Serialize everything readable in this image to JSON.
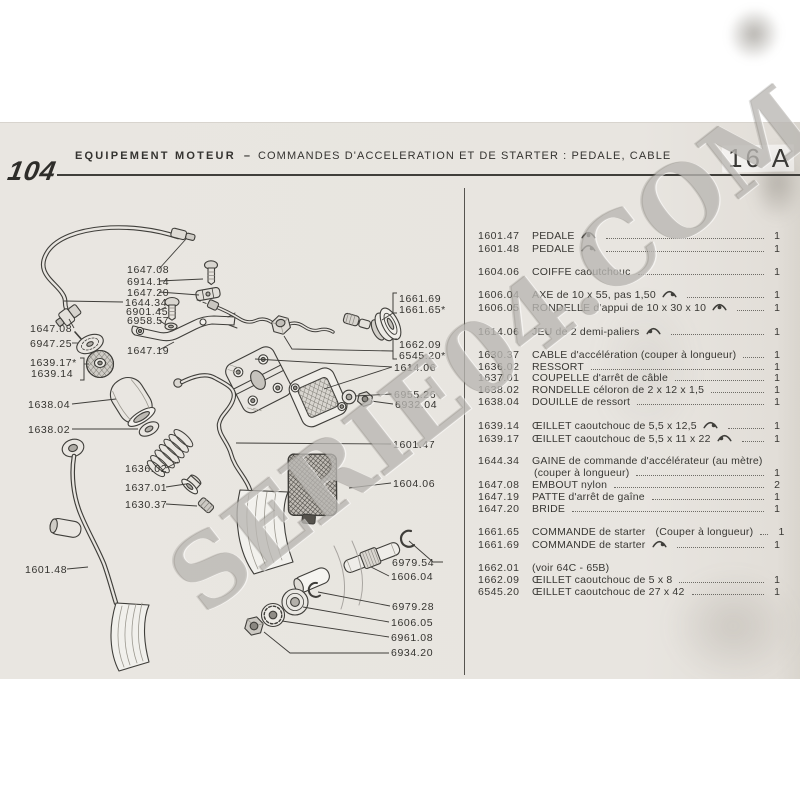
{
  "page": {
    "model": "104",
    "section_title": "EQUIPEMENT MOTEUR",
    "separator": "–",
    "subtitle": "COMMANDES D'ACCELERATION ET DE STARTER : PEDALE, CABLE",
    "page_number": "16 A"
  },
  "watermark": {
    "text": "SERIE04.COM"
  },
  "parts_list": {
    "groups": [
      [
        {
          "ref": "1601.47",
          "desc": "PEDALE",
          "icon": "c",
          "qty": "1"
        },
        {
          "ref": "1601.48",
          "desc": "PEDALE",
          "icon": "r",
          "qty": "1"
        }
      ],
      [
        {
          "ref": "1604.06",
          "desc": "COIFFE caoutchouc",
          "qty": "1"
        }
      ],
      [
        {
          "ref": "1606.04",
          "desc": "AXE de 10 x 55, pas 1,50",
          "icon": "r",
          "qty": "1"
        },
        {
          "ref": "1606.05",
          "desc": "RONDELLE d'appui de 10 x 30 x 10",
          "icon": "c",
          "qty": "1"
        }
      ],
      [
        {
          "ref": "1614.06",
          "desc": "JEU de 2 demi-paliers",
          "icon": "l",
          "qty": "1"
        }
      ],
      [
        {
          "ref": "1630.37",
          "desc": "CABLE d'accélération (couper à longueur)",
          "qty": "1"
        },
        {
          "ref": "1636.02",
          "desc": "RESSORT",
          "qty": "1"
        },
        {
          "ref": "1637.01",
          "desc": "COUPELLE d'arrêt de câble",
          "qty": "1"
        },
        {
          "ref": "1638.02",
          "desc": "RONDELLE céloron de 2 x 12 x 1,5",
          "qty": "1"
        },
        {
          "ref": "1638.04",
          "desc": "DOUILLE de ressort",
          "qty": "1"
        }
      ],
      [
        {
          "ref": "1639.14",
          "desc": "ŒILLET caoutchouc de 5,5 x 12,5",
          "icon": "r",
          "qty": "1"
        },
        {
          "ref": "1639.17",
          "desc": "ŒILLET caoutchouc de 5,5 x 11 x 22",
          "icon": "l",
          "qty": "1"
        }
      ],
      [
        {
          "ref": "1644.34",
          "desc": "GAINE de commande d'accélérateur (au mètre)",
          "desc2": "(couper à longueur)",
          "qty": "1"
        },
        {
          "ref": "1647.08",
          "desc": "EMBOUT nylon",
          "qty": "2"
        },
        {
          "ref": "1647.19",
          "desc": "PATTE d'arrêt de gaîne",
          "qty": "1"
        },
        {
          "ref": "1647.20",
          "desc": "BRIDE",
          "qty": "1"
        }
      ],
      [
        {
          "ref": "1661.65",
          "desc": "COMMANDE de starter",
          "icon": "l",
          "desc_after": "(Couper à longueur)",
          "qty": "1"
        },
        {
          "ref": "1661.69",
          "desc": "COMMANDE de starter",
          "icon": "r",
          "qty": "1"
        }
      ],
      [
        {
          "ref": "1662.01",
          "desc": "(voir 64C - 65B)"
        },
        {
          "ref": "1662.09",
          "desc": "ŒILLET caoutchouc de 5 x 8",
          "qty": "1"
        },
        {
          "ref": "6545.20",
          "desc": "ŒILLET caoutchouc de 27 x 42",
          "qty": "1"
        }
      ]
    ]
  },
  "diagram": {
    "labels": [
      {
        "text": "1647.08",
        "x": 127,
        "y": 272,
        "leaders": [
          [
            [
              159,
              268
            ],
            [
              186,
              238
            ]
          ]
        ]
      },
      {
        "text": "6914.14",
        "x": 127,
        "y": 284,
        "leaders": [
          [
            [
              159,
              280
            ],
            [
              203,
              278
            ]
          ]
        ]
      },
      {
        "text": "1647.20",
        "x": 127,
        "y": 295,
        "leaders": [
          [
            [
              159,
              291
            ],
            [
              199,
              294
            ]
          ]
        ]
      },
      {
        "text": "1644.34",
        "x": 125,
        "y": 305,
        "leaders": [
          [
            [
              123,
              301
            ],
            [
              64,
              300
            ]
          ]
        ]
      },
      {
        "text": "6901.45",
        "x": 126,
        "y": 314,
        "leaders": [
          [
            [
              158,
              310
            ],
            [
              166,
              306
            ]
          ]
        ]
      },
      {
        "text": "6958.57",
        "x": 127,
        "y": 323,
        "leaders": [
          [
            [
              159,
              319
            ],
            [
              166,
              324
            ]
          ]
        ]
      },
      {
        "text": "1647.19",
        "x": 127,
        "y": 353,
        "leaders": [
          [
            [
              159,
              349
            ],
            [
              174,
              341
            ]
          ]
        ]
      },
      {
        "text": "1647.08",
        "x": 30,
        "y": 331,
        "leaders": [
          [
            [
              74,
              327
            ],
            [
              69,
              318
            ]
          ]
        ]
      },
      {
        "text": "6947.25",
        "x": 30,
        "y": 346,
        "leaders": [
          [
            [
              72,
              342
            ],
            [
              78,
              342
            ]
          ]
        ]
      },
      {
        "text": "1639.17*",
        "x": 30,
        "y": 365,
        "leaders": []
      },
      {
        "text": "1639.14",
        "x": 31,
        "y": 376,
        "leaders": []
      },
      {
        "text": "1638.04",
        "x": 28,
        "y": 407,
        "leaders": [
          [
            [
              72,
              403
            ],
            [
              116,
              398
            ]
          ]
        ]
      },
      {
        "text": "1638.02",
        "x": 28,
        "y": 432,
        "leaders": [
          [
            [
              72,
              428
            ],
            [
              138,
              428
            ]
          ]
        ]
      },
      {
        "text": "1636.02",
        "x": 125,
        "y": 471,
        "leaders": [
          [
            [
              166,
              467
            ],
            [
              178,
              461
            ]
          ]
        ]
      },
      {
        "text": "1637.01",
        "x": 125,
        "y": 490,
        "leaders": [
          [
            [
              166,
              486
            ],
            [
              186,
              483
            ]
          ]
        ]
      },
      {
        "text": "1630.37",
        "x": 125,
        "y": 507,
        "leaders": [
          [
            [
              166,
              503
            ],
            [
              197,
              505
            ]
          ]
        ]
      },
      {
        "text": "1601.48",
        "x": 25,
        "y": 572,
        "leaders": [
          [
            [
              67,
              568
            ],
            [
              88,
              566
            ]
          ]
        ]
      },
      {
        "text": "1661.69",
        "x": 399,
        "y": 301,
        "leaders": []
      },
      {
        "text": "1661.65*",
        "x": 399,
        "y": 312,
        "leaders": []
      },
      {
        "text": "1662.09",
        "x": 399,
        "y": 347,
        "leaders": []
      },
      {
        "text": "6545.20*",
        "x": 399,
        "y": 358,
        "leaders": []
      },
      {
        "text": "1614.06",
        "x": 394,
        "y": 370,
        "leaders": [
          [
            [
              392,
              366
            ],
            [
              255,
              358
            ]
          ],
          [
            [
              392,
              366
            ],
            [
              324,
              388
            ]
          ]
        ]
      },
      {
        "text": "6955.26",
        "x": 394,
        "y": 397,
        "leaders": [
          [
            [
              392,
              393
            ],
            [
              355,
              395
            ]
          ]
        ]
      },
      {
        "text": "6932.04",
        "x": 395,
        "y": 407,
        "leaders": [
          [
            [
              393,
              403
            ],
            [
              371,
              400
            ]
          ]
        ]
      },
      {
        "text": "1601.47",
        "x": 393,
        "y": 447,
        "leaders": [
          [
            [
              391,
              443
            ],
            [
              236,
              442
            ]
          ]
        ]
      },
      {
        "text": "1604.06",
        "x": 393,
        "y": 486,
        "leaders": [
          [
            [
              391,
              482
            ],
            [
              349,
              487
            ]
          ]
        ]
      },
      {
        "text": "6979.54",
        "x": 392,
        "y": 565,
        "leaders": [
          [
            [
              443,
              561
            ],
            [
              433,
              561
            ],
            [
              409,
              540
            ]
          ]
        ]
      },
      {
        "text": "1606.04",
        "x": 391,
        "y": 579,
        "leaders": [
          [
            [
              389,
              575
            ],
            [
              371,
              566
            ]
          ]
        ]
      },
      {
        "text": "6979.28",
        "x": 392,
        "y": 609,
        "leaders": [
          [
            [
              390,
              605
            ],
            [
              318,
              591
            ]
          ]
        ]
      },
      {
        "text": "1606.05",
        "x": 391,
        "y": 625,
        "leaders": [
          [
            [
              389,
              621
            ],
            [
              303,
              606
            ]
          ]
        ]
      },
      {
        "text": "6961.08",
        "x": 391,
        "y": 640,
        "leaders": [
          [
            [
              389,
              636
            ],
            [
              282,
              620
            ]
          ]
        ]
      },
      {
        "text": "6934.20",
        "x": 391,
        "y": 655,
        "leaders": [
          [
            [
              389,
              652
            ],
            [
              290,
              652
            ],
            [
              264,
              631
            ]
          ]
        ]
      }
    ],
    "brackets": [
      {
        "x": 84,
        "y1": 357,
        "y2": 379,
        "tick": -4,
        "leader": [
          [
            84,
            363
          ],
          [
            89,
            363
          ]
        ]
      },
      {
        "x": 393,
        "y1": 292,
        "y2": 312,
        "tick": 4,
        "leader": [
          [
            393,
            312
          ],
          [
            382,
            319
          ]
        ]
      },
      {
        "x": 393,
        "y1": 338,
        "y2": 358,
        "tick": 4,
        "leader": [
          [
            393,
            350
          ],
          [
            292,
            348
          ],
          [
            284,
            335
          ]
        ]
      }
    ]
  },
  "colors": {
    "paper": "#e8e5e0",
    "ink": "#3f3e3a",
    "label_ink": "#34332f",
    "watermark": "#8f8b84"
  }
}
